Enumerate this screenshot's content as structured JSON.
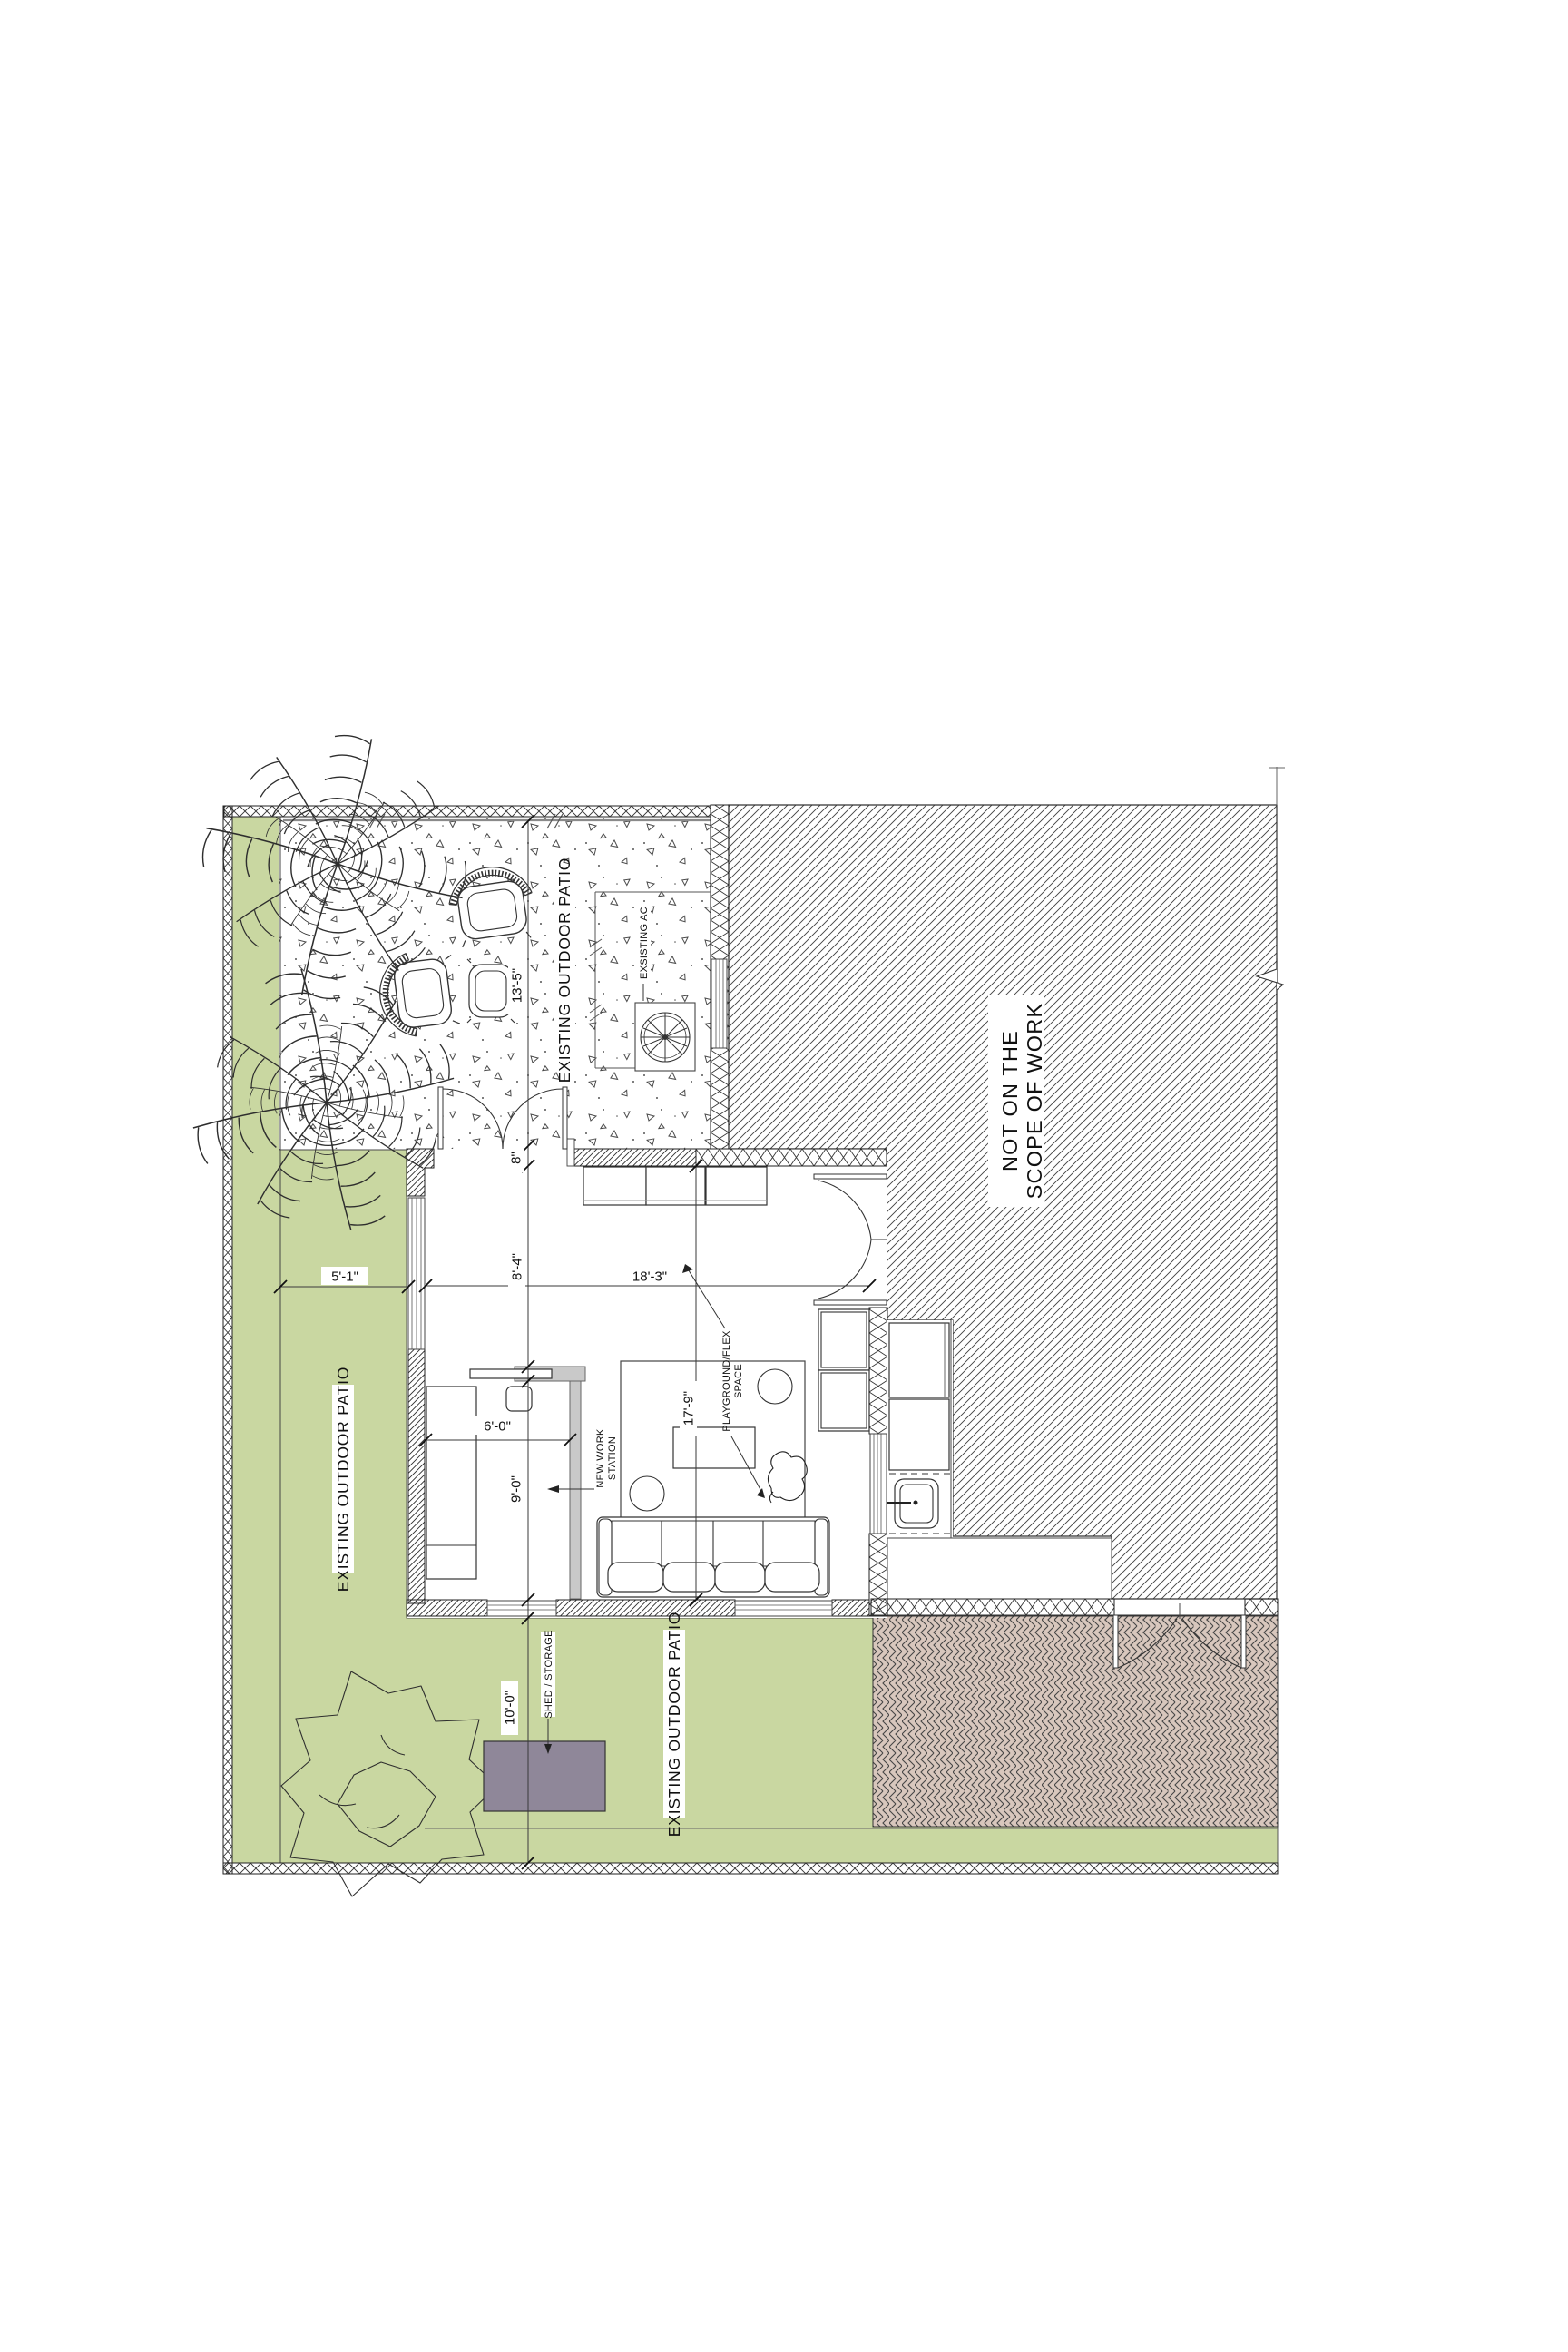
{
  "labels": {
    "patio": "EXISTING OUTDOOR PATIO",
    "scope1": "NOT ON THE",
    "scope2": "SCOPE OF WORK",
    "ac": "EXSISTING AC",
    "shed": "SHED / STORAGE",
    "work1": "NEW WORK",
    "work2": "STATION",
    "play1": "PLAYGROUND/FLEX",
    "play2": "SPACE"
  },
  "dimensions": {
    "patio_width": "13'-5\"",
    "wall_thickness": "8\"",
    "upper_room": "8'-4\"",
    "room_width": "18'-3\"",
    "desk_zone": "6'-0\"",
    "lower_room": "9'-0\"",
    "room_depth": "17'-9\"",
    "yard_depth": "10'-0\"",
    "side_yard": "5'-1\""
  },
  "colors": {
    "lawn": "#c9d7a1",
    "brick": "#d8c7bd",
    "brick_line": "#454545",
    "shed": "#8f8799",
    "desk": "#c9c9c9",
    "line": "#333333"
  }
}
